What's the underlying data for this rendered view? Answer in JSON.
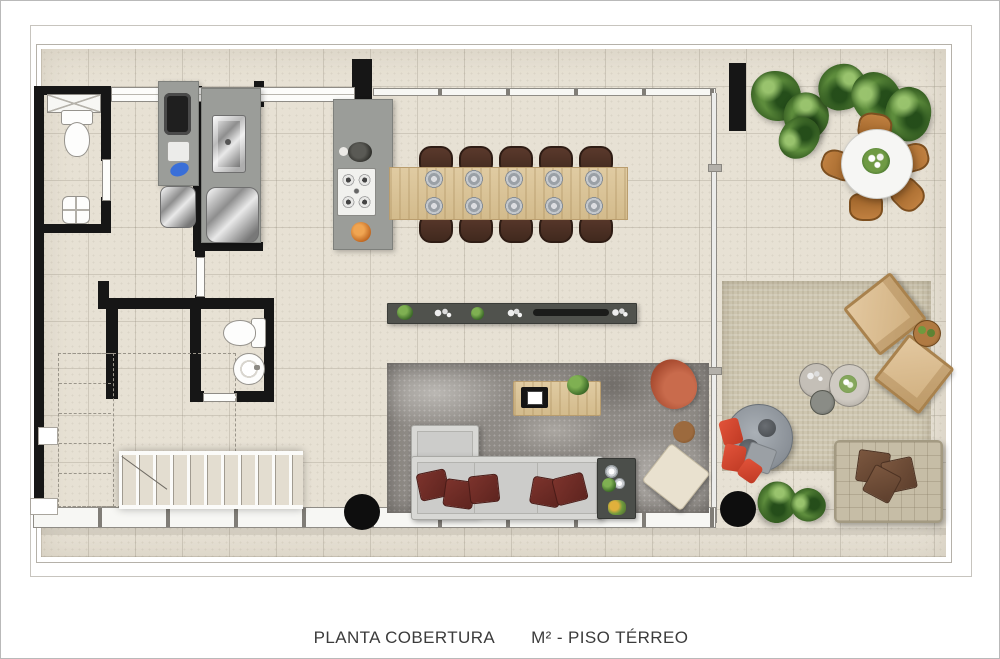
{
  "caption": {
    "plan_label": "PLANTA COBERTURA",
    "area_label": "M² - PISO TÉRREO"
  },
  "palette": {
    "floor": "#e7e1d4",
    "wall": "#161616",
    "counter_gray": "#9b9d99",
    "wood": "#d9c49a",
    "dining_chair_brown": "#4e3328",
    "living_rug_gray": "#8f8b86",
    "sofa_gray": "#cccccA",
    "pillow_dark_red": "#6e2b26",
    "armchair_rust": "#b5593a",
    "outdoor_rug_beige": "#cec6b0",
    "lounge_tan": "#d9b98c",
    "daybed_gray": "#9aa0a6",
    "daybed_pillow_red": "#d7462e",
    "plant_green": "#3a6325",
    "terrace_chair_amber": "#b5763a"
  },
  "elements": [
    "suite-bathroom-with-window-toilet-sink",
    "laundry-counter-with-sink-and-boilers",
    "tall-cabinet-with-oven",
    "kitchen-island-with-cooktop",
    "dining-table-10-seats-10-place-settings",
    "media-sideboard-with-fireplace-slot",
    "living-rug-l-shaped-sofa-5-red-pillows",
    "coffee-table-with-tv-and-plant",
    "rust-armchair-side-table-ottoman",
    "serving-table-dark",
    "powder-room-toilet-round-sink",
    "staircase-11-treads",
    "void-projection-dashed-lines",
    "glass-facade-with-columns",
    "terrace-round-table-5-chairs-centerpiece",
    "terrace-planting-6-shrubs",
    "outdoor-lounge-2-chairs-3-coffee-tables",
    "round-daybed-red-pillows",
    "outdoor-sectional-3-brown-pillows",
    "2-structural-columns"
  ]
}
